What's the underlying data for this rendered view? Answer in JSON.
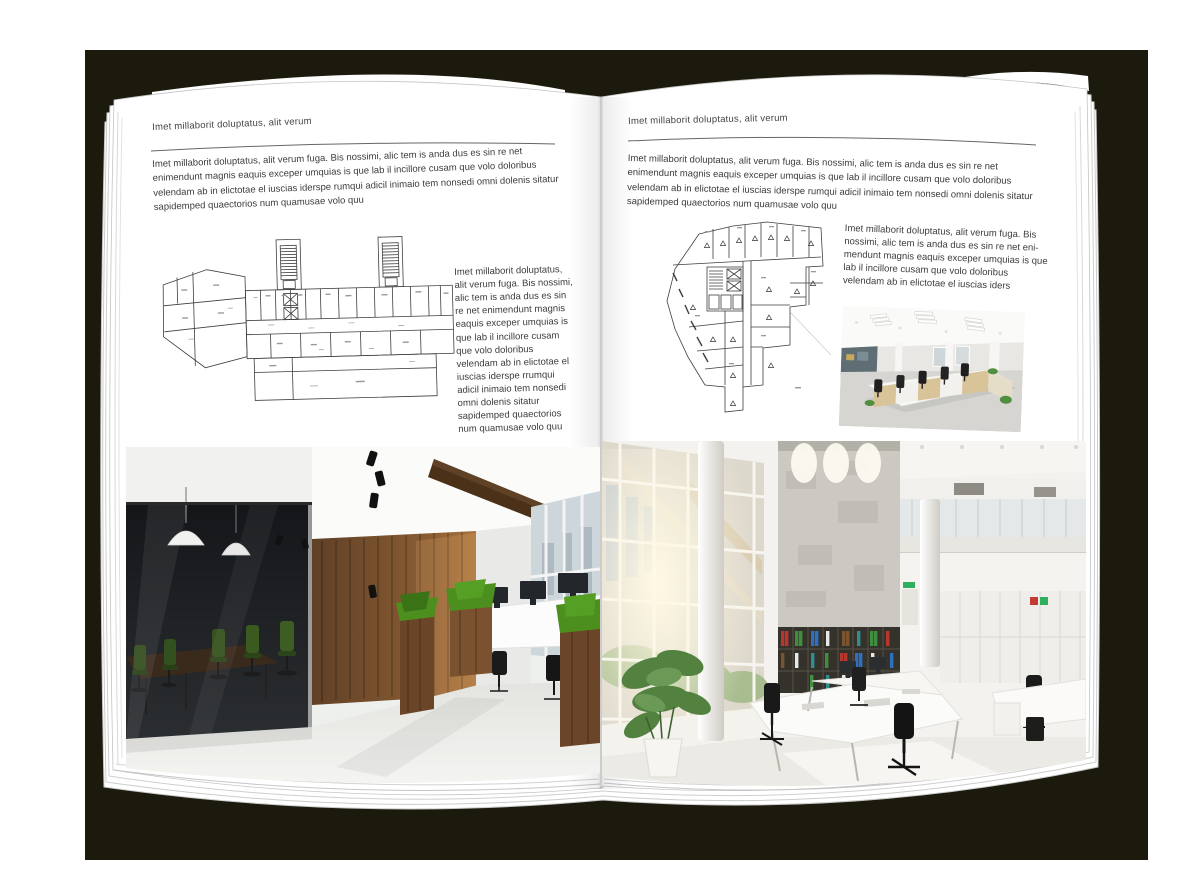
{
  "colors": {
    "backdrop": "#1b1a0d",
    "page": "#ffffff",
    "body_text": "#3c3c3c",
    "plan_line": "#3f3f3f",
    "wood": "#7a5230",
    "wood_dark": "#4a3117",
    "grass_green": "#4c8f1f",
    "meeting_chair_green": "#36521d",
    "binder_red": "#b5372e",
    "binder_green": "#3f8f3f",
    "binder_blue": "#2f6fbf",
    "exit_sign_green": "#2fae5f"
  },
  "left_page": {
    "running_head": "Imet millaborit doluptatus, alit verum",
    "intro": "Imet millaborit doluptatus, alit verum fuga. Bis nossimi, alic tem is anda dus es sin re net enimendunt magnis eaquis exceper umquias is que lab il incillore cusam que volo doloribus velendam ab in elictotae el iuscias iderspe rumqui adicil inimaio tem nonsedi omni dolenis sitatur sapidemped quaectorios num quamusae volo quu",
    "side_text": "Imet millaborit doluptatus, alit verum fuga. Bis nossimi, alic tem is anda dus es sin re net enimendunt magnis eaquis exceper umquias is que lab il incillore cusam que volo doloribus velendam ab in elictotae el iuscias iderspe rrumqui adicil inimaio tem nonsedi omni dolenis sitatur sapidemped quaectorios num quamusae volo quu",
    "floor_plan": "wide-office-building-floor-plan-with-two-stair-towers",
    "photo": "dark-wood-and-glass-office-interior-photo"
  },
  "right_page": {
    "running_head": "Imet millaborit doluptatus, alit verum",
    "intro": "Imet millaborit doluptatus, alit verum fuga. Bis nossimi, alic tem is anda dus es sin re net enimendunt magnis eaquis exceper umquias is que lab il incillore cusam que volo doloribus velendam ab in elictotae el iuscias iderspe rumqui adicil inimaio tem nonsedi omni dolenis sitatur sapidemped quaectorios num quamusae volo quu",
    "side_text": "Imet millaborit doluptatus, alit verum fuga. Bis nossimi, alic tem is anda dus es sin re net eni-mendunt magnis eaquis exceper umquias is que lab il incillore cusam que volo doloribus velendam ab in elictotae el iuscias iders",
    "floor_plan": "irregular-corner-building-floor-plan",
    "photo_small": "open-plan-workstations-office-photo",
    "photo_large": "bright-double-height-office-interior-photo"
  }
}
